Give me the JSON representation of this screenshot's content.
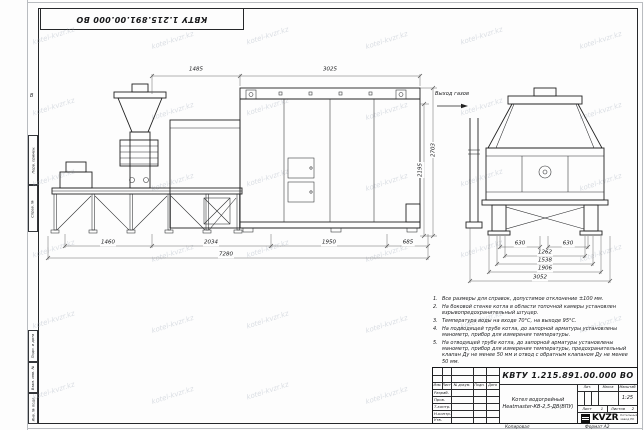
{
  "watermark": {
    "text": "kotel-kvzr.kz"
  },
  "sheet": {
    "zone_label": "В",
    "margin_labels": [
      "Перв. примен.",
      "Справ. №",
      "Подп. и дата",
      "Взам. инв. №",
      "Инв. № подл."
    ],
    "footer": {
      "copied": "Копировал",
      "format": "Формат А2"
    }
  },
  "stamp_top": {
    "designation": "КВТУ 1.215.891.00.000 ВО"
  },
  "drawing": {
    "annotations": {
      "gas_outlet": "Выход газов"
    },
    "dims": {
      "top_left": "1485",
      "top_right": "3025",
      "right_inner": "2195",
      "right_outer": "2703",
      "bottom_1": "1460",
      "bottom_2": "2034",
      "bottom_3": "1950",
      "bottom_4": "685",
      "bottom_total": "7280",
      "side_630_left": "630",
      "side_630_right": "630",
      "side_1262": "1262",
      "side_1538": "1538",
      "side_1906": "1906",
      "side_total": "3052"
    }
  },
  "notes": {
    "items": [
      {
        "n": "1.",
        "t": "Все размеры для справок, допустимое отклонение ±100 мм."
      },
      {
        "n": "2.",
        "t": "На боковой стенке котла в области топочной камеры установлен взрывопредохранительный штуцер."
      },
      {
        "n": "3.",
        "t": "Температура воды на входе 70°С, на выходе 95°С."
      },
      {
        "n": "4.",
        "t": "На подводящей трубе котла, до запорной арматуры установлены манометр, прибор для измерения температуры."
      },
      {
        "n": "5.",
        "t": "На отводящей трубе котла, до запорной арматуры установлены манометр, прибор для измерения температуры, предохранительный клапан Ду не менее 50 мм и отвод с обратным клапаном Ду не менее 50 мм."
      }
    ]
  },
  "title_block": {
    "designation": "КВТУ 1.215.891.00.000 ВО",
    "name_line1": "Котел водогрейный",
    "name_line2": "Heatmaster-КВ-2,5-ДВ(ВПУ)",
    "cols": [
      "Изм.",
      "Лист",
      "№ докум.",
      "Подп.",
      "Дата"
    ],
    "rows": [
      "Разраб.",
      "Пров.",
      "Т.контр.",
      "Н.контр.",
      "Утв."
    ],
    "lit_label": "Лит.",
    "mass_label": "Масса",
    "scale_label": "Масштаб",
    "scale_value": "1:25",
    "sheet_label": "Лист",
    "sheet_value": "1",
    "sheets_label": "Листов",
    "sheets_value": "2",
    "brand": "KVZR",
    "brand_sub1": "Котельный",
    "brand_sub2": "завод РК"
  },
  "colors": {
    "line": "#222222",
    "dim": "#555555",
    "watermark": "#aab3c0"
  }
}
